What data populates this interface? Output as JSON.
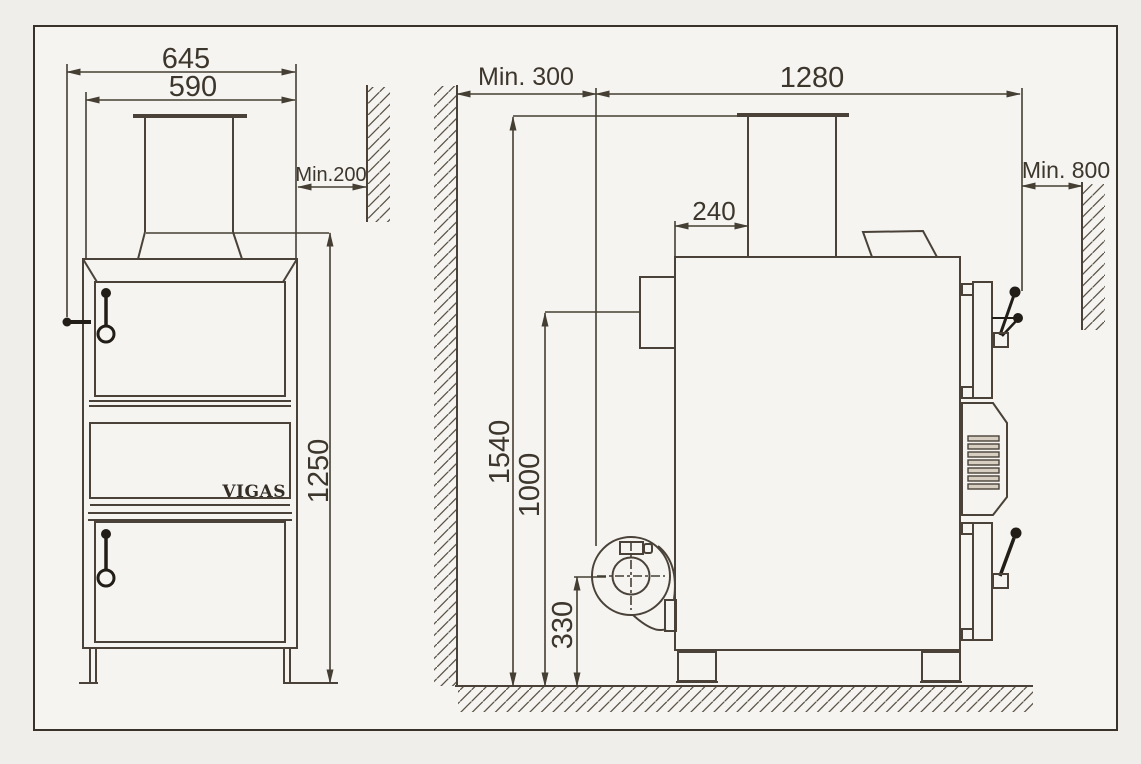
{
  "drawing": {
    "brand": "VIGAS",
    "front_view": {
      "dim_width_overall": "645",
      "dim_width_body": "590",
      "dim_wall_clearance": "Min.200",
      "dim_height_body": "1250"
    },
    "side_view": {
      "dim_clearance_rear": "Min. 300",
      "dim_depth_overall": "1280",
      "dim_clearance_front": "Min. 800",
      "dim_chimney_offset": "240",
      "dim_height_chimney": "1540",
      "dim_height_flue_outlet": "1000",
      "dim_height_fan_axis": "330"
    },
    "colors": {
      "line": "#4a4238",
      "dark": "#221d17",
      "background": "#f5f4f1",
      "frame_border": "#38322a"
    }
  }
}
